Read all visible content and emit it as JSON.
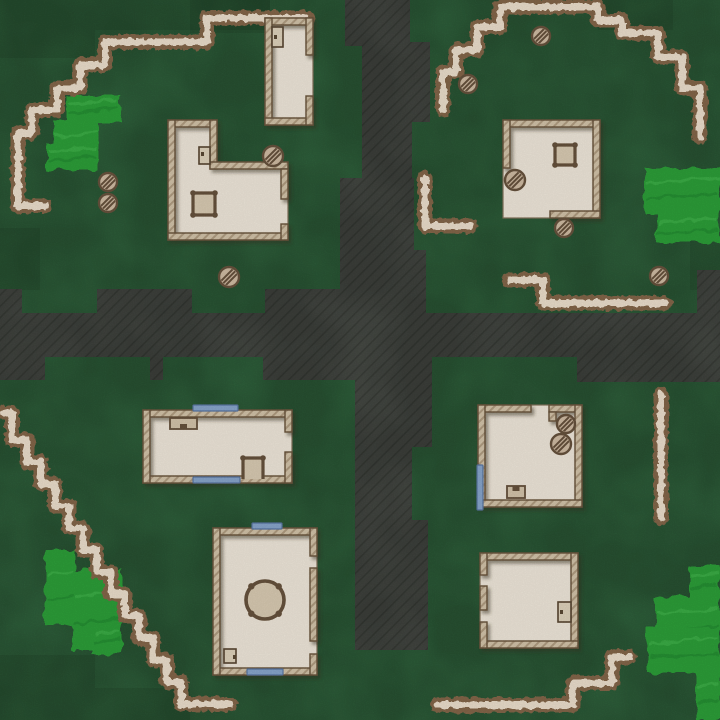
{
  "map": {
    "width": 720,
    "height": 720,
    "colors": {
      "grass": "#31683f",
      "grass_dark": "#16321f",
      "road": "#4b4f49",
      "road_line": "#3f433d",
      "path_brown": "#8a6c4e",
      "path_cream": "#e9ddcc",
      "bush": "#2fa23b",
      "bush_light": "#4cbb55",
      "bush_dark": "#1f8c30",
      "wall_fill": "#d2c4ac",
      "wall_hatch": "#b3a188",
      "wall_stroke": "#6f5a40",
      "floor": "#ece5d9",
      "floor_stroke": "#8a7a62",
      "furn_stroke": "#6d5740",
      "furn_fill": "#d8cbb5",
      "chair_fill": "#d3c5ae",
      "rock_fill": "#cfbda7",
      "rock_stroke": "#6d5740",
      "window_fill": "#8ea9cb",
      "window_stroke": "#5f7ea6",
      "door_fill": "#ddd2bd",
      "door_stroke": "#5f4c36"
    },
    "dark_patches": [
      [
        0,
        0,
        95,
        58
      ],
      [
        95,
        0,
        175,
        30
      ],
      [
        190,
        0,
        80,
        33
      ],
      [
        598,
        0,
        75,
        30
      ],
      [
        0,
        228,
        40,
        62
      ],
      [
        690,
        235,
        30,
        55
      ],
      [
        0,
        655,
        95,
        65
      ],
      [
        95,
        688,
        95,
        32
      ]
    ],
    "roads": [
      [
        345,
        0,
        65,
        46
      ],
      [
        362,
        42,
        68,
        80
      ],
      [
        362,
        120,
        50,
        60
      ],
      [
        340,
        178,
        74,
        77
      ],
      [
        340,
        250,
        86,
        65
      ],
      [
        0,
        313,
        720,
        44
      ],
      [
        0,
        289,
        22,
        26
      ],
      [
        97,
        289,
        95,
        26
      ],
      [
        265,
        289,
        80,
        26
      ],
      [
        697,
        270,
        23,
        45
      ],
      [
        0,
        357,
        45,
        23
      ],
      [
        150,
        357,
        13,
        23
      ],
      [
        263,
        357,
        97,
        23
      ],
      [
        577,
        357,
        143,
        25
      ],
      [
        355,
        357,
        77,
        90
      ],
      [
        355,
        445,
        57,
        82
      ],
      [
        355,
        520,
        73,
        45
      ],
      [
        355,
        560,
        73,
        90
      ]
    ],
    "bushes": [
      [
        68,
        95,
        52,
        27
      ],
      [
        55,
        120,
        43,
        50
      ],
      [
        47,
        143,
        50,
        27
      ],
      [
        645,
        168,
        75,
        45
      ],
      [
        656,
        213,
        64,
        30
      ],
      [
        45,
        550,
        30,
        75
      ],
      [
        72,
        570,
        50,
        80
      ],
      [
        92,
        625,
        30,
        28
      ],
      [
        690,
        565,
        30,
        35
      ],
      [
        655,
        597,
        65,
        50
      ],
      [
        647,
        627,
        73,
        46
      ],
      [
        697,
        670,
        23,
        50
      ]
    ],
    "paths": [
      {
        "points": [
          [
            307,
            18
          ],
          [
            207,
            18
          ],
          [
            207,
            42
          ],
          [
            105,
            42
          ],
          [
            105,
            65
          ],
          [
            80,
            65
          ],
          [
            80,
            88
          ],
          [
            57,
            88
          ],
          [
            57,
            110
          ],
          [
            32,
            110
          ],
          [
            32,
            133
          ],
          [
            18,
            133
          ],
          [
            18,
            206
          ],
          [
            45,
            206
          ]
        ]
      },
      {
        "points": [
          [
            443,
            110
          ],
          [
            443,
            72
          ],
          [
            456,
            72
          ],
          [
            456,
            50
          ],
          [
            477,
            50
          ],
          [
            477,
            27
          ],
          [
            500,
            27
          ],
          [
            500,
            7
          ],
          [
            598,
            7
          ],
          [
            598,
            20
          ],
          [
            622,
            20
          ],
          [
            622,
            33
          ],
          [
            658,
            33
          ],
          [
            658,
            57
          ],
          [
            682,
            57
          ],
          [
            682,
            88
          ],
          [
            700,
            88
          ],
          [
            700,
            137
          ]
        ]
      },
      {
        "points": [
          [
            425,
            178
          ],
          [
            425,
            226
          ],
          [
            470,
            226
          ]
        ]
      },
      {
        "points": [
          [
            510,
            280
          ],
          [
            543,
            280
          ],
          [
            543,
            303
          ],
          [
            665,
            303
          ]
        ]
      },
      {
        "points": [
          [
            4,
            413
          ],
          [
            12,
            413
          ],
          [
            12,
            440
          ],
          [
            27,
            440
          ],
          [
            27,
            462
          ],
          [
            41,
            462
          ],
          [
            41,
            484
          ],
          [
            55,
            484
          ],
          [
            55,
            506
          ],
          [
            69,
            506
          ],
          [
            69,
            528
          ],
          [
            83,
            528
          ],
          [
            83,
            550
          ],
          [
            97,
            550
          ],
          [
            97,
            572
          ],
          [
            111,
            572
          ],
          [
            111,
            594
          ],
          [
            125,
            594
          ],
          [
            125,
            616
          ],
          [
            139,
            616
          ],
          [
            139,
            638
          ],
          [
            153,
            638
          ],
          [
            153,
            660
          ],
          [
            167,
            660
          ],
          [
            167,
            682
          ],
          [
            181,
            682
          ],
          [
            181,
            704
          ],
          [
            230,
            704
          ]
        ]
      },
      {
        "points": [
          [
            661,
            394
          ],
          [
            661,
            518
          ]
        ]
      },
      {
        "points": [
          [
            437,
            705
          ],
          [
            573,
            705
          ],
          [
            573,
            683
          ],
          [
            612,
            683
          ],
          [
            612,
            657
          ],
          [
            630,
            657
          ]
        ]
      }
    ],
    "buildings": [
      {
        "name": "house-top-center",
        "floor": {
          "rect": [
            265,
            18,
            48,
            107
          ]
        },
        "walls": [
          [
            265,
            18,
            48,
            7
          ],
          [
            265,
            18,
            7,
            107
          ],
          [
            265,
            118,
            48,
            7
          ],
          [
            306,
            18,
            7,
            37
          ],
          [
            306,
            96,
            7,
            29
          ]
        ],
        "windows": [],
        "doors": [
          {
            "rect": [
              272,
              27,
              11,
              20
            ],
            "handle": [
              274,
              35
            ]
          }
        ],
        "furniture": []
      },
      {
        "name": "house-L-top-left",
        "floor": {
          "poly": [
            [
              168,
              120
            ],
            [
              217,
              120
            ],
            [
              217,
              162
            ],
            [
              288,
              162
            ],
            [
              288,
              240
            ],
            [
              168,
              240
            ]
          ]
        },
        "walls": [
          [
            168,
            120,
            49,
            7
          ],
          [
            168,
            120,
            7,
            120
          ],
          [
            168,
            233,
            120,
            7
          ],
          [
            210,
            120,
            7,
            49
          ],
          [
            210,
            162,
            78,
            7
          ],
          [
            281,
            169,
            7,
            30
          ],
          [
            281,
            224,
            7,
            16
          ]
        ],
        "windows": [],
        "doors": [
          {
            "rect": [
              199,
              147,
              11,
              17
            ],
            "handle": [
              201,
              152
            ]
          }
        ],
        "furniture": [
          {
            "type": "table",
            "x": 193,
            "y": 193,
            "s": 22
          }
        ]
      },
      {
        "name": "house-top-right",
        "floor": {
          "rect": [
            503,
            120,
            97,
            98
          ]
        },
        "walls": [
          [
            503,
            120,
            97,
            7
          ],
          [
            593,
            120,
            7,
            98
          ],
          [
            503,
            120,
            7,
            48
          ],
          [
            550,
            211,
            50,
            7
          ]
        ],
        "windows": [],
        "doors": [],
        "furniture": [
          {
            "type": "table",
            "x": 555,
            "y": 145,
            "s": 20
          }
        ]
      },
      {
        "name": "house-wide-bottom-left",
        "floor": {
          "rect": [
            143,
            410,
            149,
            73
          ]
        },
        "walls": [
          [
            143,
            410,
            149,
            7
          ],
          [
            143,
            476,
            149,
            7
          ],
          [
            143,
            410,
            7,
            73
          ],
          [
            285,
            410,
            7,
            22
          ],
          [
            285,
            452,
            7,
            31
          ]
        ],
        "windows": [
          [
            193,
            405,
            45,
            6
          ],
          [
            193,
            477,
            47,
            6
          ]
        ],
        "doors": [],
        "furniture": [
          {
            "type": "chair",
            "x": 170,
            "y": 418,
            "w": 27,
            "h": 11,
            "notch": "bottom"
          },
          {
            "type": "ptable",
            "x": 243,
            "y": 458,
            "w": 20,
            "h": 21
          }
        ]
      },
      {
        "name": "house-tall-bottom-left",
        "floor": {
          "rect": [
            213,
            528,
            104,
            147
          ]
        },
        "walls": [
          [
            213,
            528,
            104,
            7
          ],
          [
            213,
            668,
            104,
            7
          ],
          [
            213,
            528,
            7,
            147
          ],
          [
            310,
            528,
            7,
            28
          ],
          [
            310,
            568,
            7,
            73
          ],
          [
            310,
            654,
            7,
            21
          ]
        ],
        "windows": [
          [
            252,
            523,
            30,
            6
          ],
          [
            247,
            669,
            36,
            6
          ]
        ],
        "doors": [
          {
            "rect": [
              224,
              649,
              12,
              14
            ],
            "handle": [
              233,
              655
            ]
          }
        ],
        "furniture": [
          {
            "type": "roundtable",
            "cx": 265,
            "cy": 600,
            "r": 19
          }
        ]
      },
      {
        "name": "house-bottom-right-1",
        "floor": {
          "rect": [
            478,
            405,
            104,
            102
          ]
        },
        "walls": [
          [
            478,
            405,
            53,
            7
          ],
          [
            549,
            405,
            33,
            7
          ],
          [
            549,
            412,
            7,
            9
          ],
          [
            478,
            405,
            7,
            102
          ],
          [
            575,
            405,
            7,
            102
          ],
          [
            478,
            500,
            104,
            7
          ]
        ],
        "windows": [
          [
            477,
            465,
            6,
            45
          ]
        ],
        "doors": [],
        "furniture": [
          {
            "type": "chair",
            "x": 507,
            "y": 486,
            "w": 18,
            "h": 12,
            "notch": "top"
          }
        ]
      },
      {
        "name": "house-bottom-right-2",
        "floor": {
          "rect": [
            480,
            553,
            98,
            95
          ]
        },
        "walls": [
          [
            480,
            553,
            98,
            7
          ],
          [
            571,
            553,
            7,
            95
          ],
          [
            480,
            641,
            98,
            7
          ],
          [
            480,
            553,
            7,
            22
          ],
          [
            480,
            586,
            7,
            24
          ],
          [
            480,
            622,
            7,
            26
          ]
        ],
        "windows": [],
        "doors": [
          {
            "rect": [
              558,
              602,
              13,
              20
            ],
            "handle": [
              560,
              610
            ]
          }
        ],
        "furniture": []
      }
    ],
    "rocks": [
      [
        108,
        182,
        9
      ],
      [
        108,
        203,
        9
      ],
      [
        229,
        277,
        10
      ],
      [
        273,
        156,
        10
      ],
      [
        541,
        36,
        9
      ],
      [
        468,
        84,
        9
      ],
      [
        515,
        180,
        10
      ],
      [
        564,
        228,
        9
      ],
      [
        659,
        276,
        9
      ],
      [
        566,
        424,
        9
      ],
      [
        561,
        444,
        10
      ]
    ]
  }
}
